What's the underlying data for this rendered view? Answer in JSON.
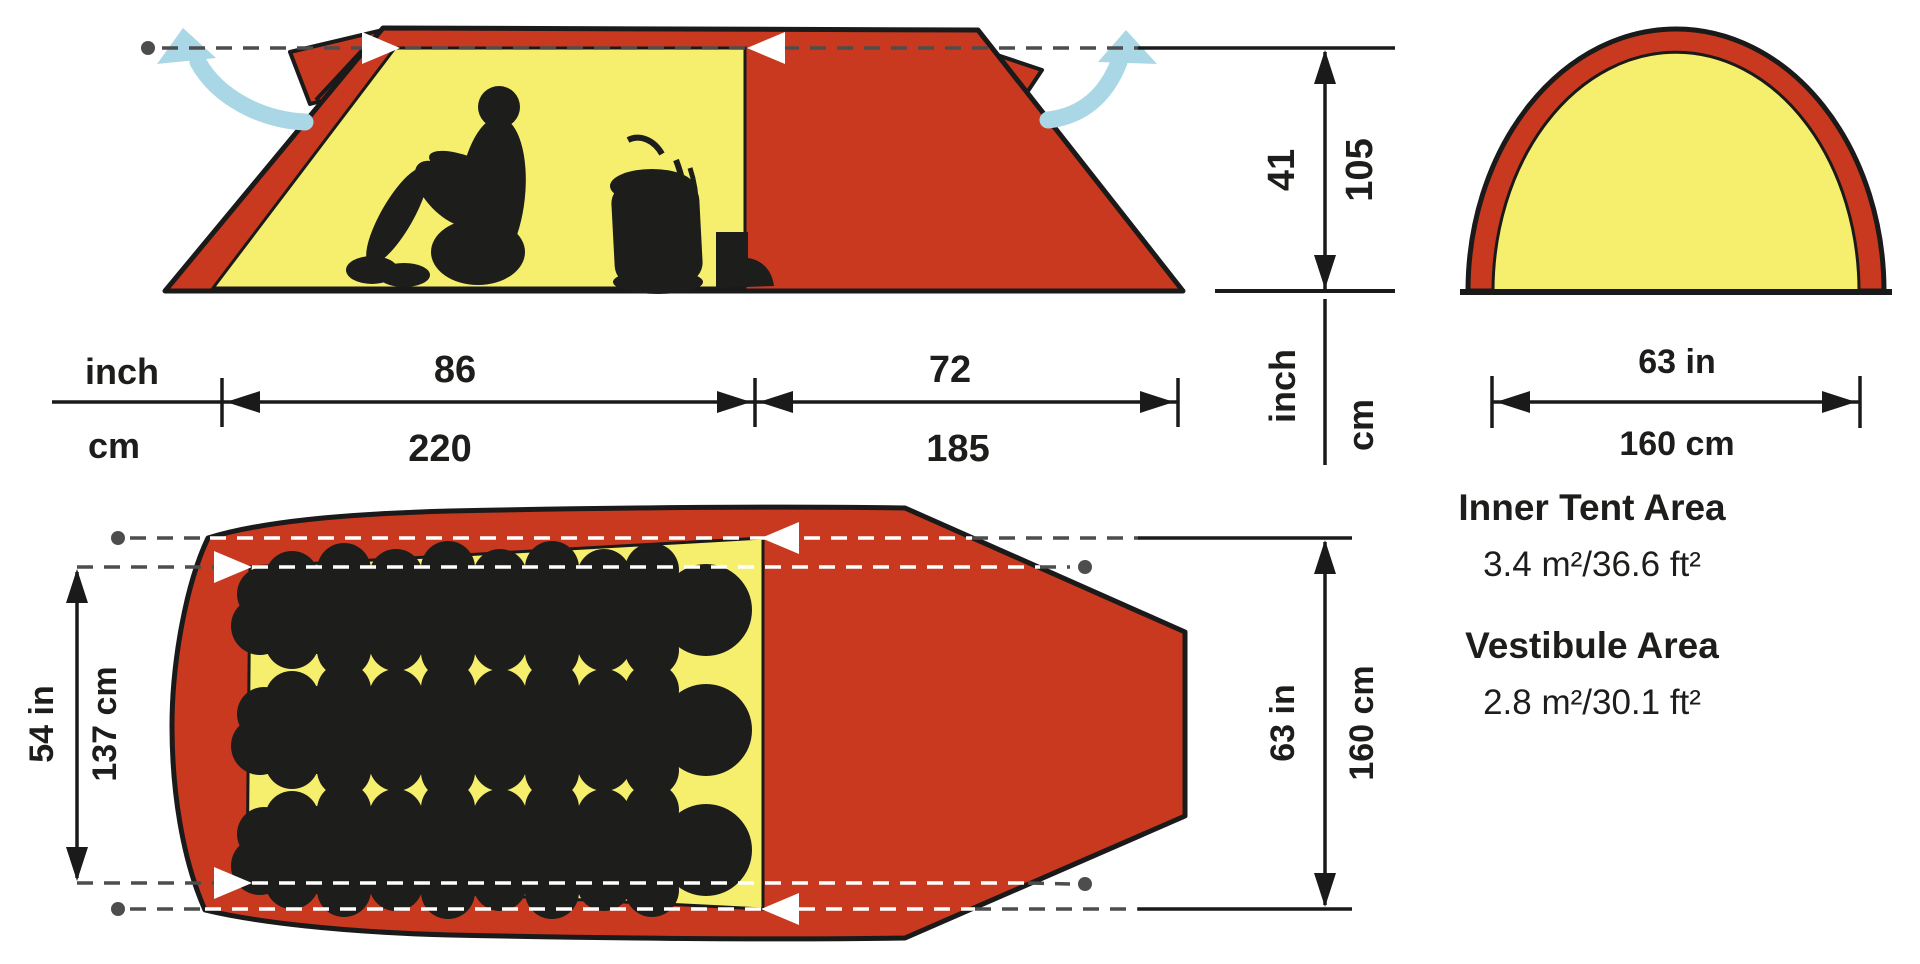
{
  "colors": {
    "red": "#c9391f",
    "yellow": "#f6ef6d",
    "outline": "#1a1a1a",
    "silhouette": "#1d1d1b",
    "dash_gray": "#4d4d4d",
    "white": "#ffffff",
    "blue": "#a9d7e6",
    "text": "#1d1d1b"
  },
  "length_dim": {
    "unit_top": "inch",
    "unit_bottom": "cm",
    "inner_top": "86",
    "inner_bottom": "220",
    "vestibule_top": "72",
    "vestibule_bottom": "185"
  },
  "height_dim": {
    "value_in": "41",
    "value_cm": "105",
    "unit_in": "inch",
    "unit_cm": "cm"
  },
  "end_view": {
    "width_in": "63 in",
    "width_cm": "160 cm"
  },
  "top_view": {
    "inner_width_in": "54 in",
    "inner_width_cm": "137 cm",
    "outer_width_in": "63 in",
    "outer_width_cm": "160 cm"
  },
  "areas": {
    "inner_title": "Inner Tent Area",
    "inner_value": "3.4 m²/36.6 ft²",
    "vestibule_title": "Vestibule Area",
    "vestibule_value": "2.8 m²/30.1 ft²"
  }
}
